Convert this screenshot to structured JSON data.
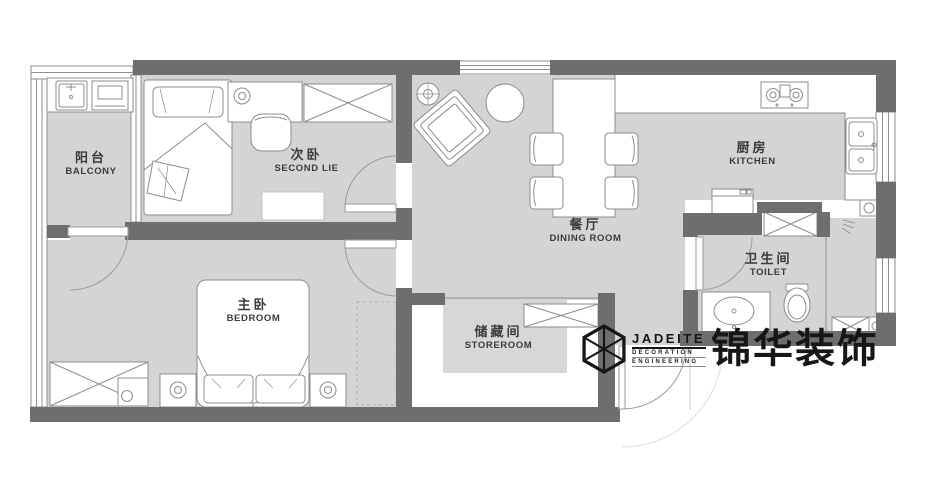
{
  "title": "apartment floor plan",
  "colors": {
    "wall": "#6e6e6e",
    "floor": "#d4d4d4",
    "furniture_line": "#8c8c8c",
    "label_text": "#3b3b3b",
    "logo": "#161616"
  },
  "rooms": [
    {
      "id": "balcony",
      "zh": "阳台",
      "en": "BALCONY"
    },
    {
      "id": "second-bedroom",
      "zh": "次卧",
      "en": "SECOND LIE"
    },
    {
      "id": "dining-room",
      "zh": "餐厅",
      "en": "DINING ROOM"
    },
    {
      "id": "kitchen",
      "zh": "厨房",
      "en": "KITCHEN"
    },
    {
      "id": "toilet",
      "zh": "卫生间",
      "en": "TOILET"
    },
    {
      "id": "master-bedroom",
      "zh": "主卧",
      "en": "BEDROOM"
    },
    {
      "id": "storeroom",
      "zh": "储藏间",
      "en": "STOREROOM"
    }
  ],
  "logo": {
    "name": "JADEITE",
    "sub1": "DECORATION",
    "sub2": "ENGINEERING",
    "cn": "锦华装饰"
  }
}
